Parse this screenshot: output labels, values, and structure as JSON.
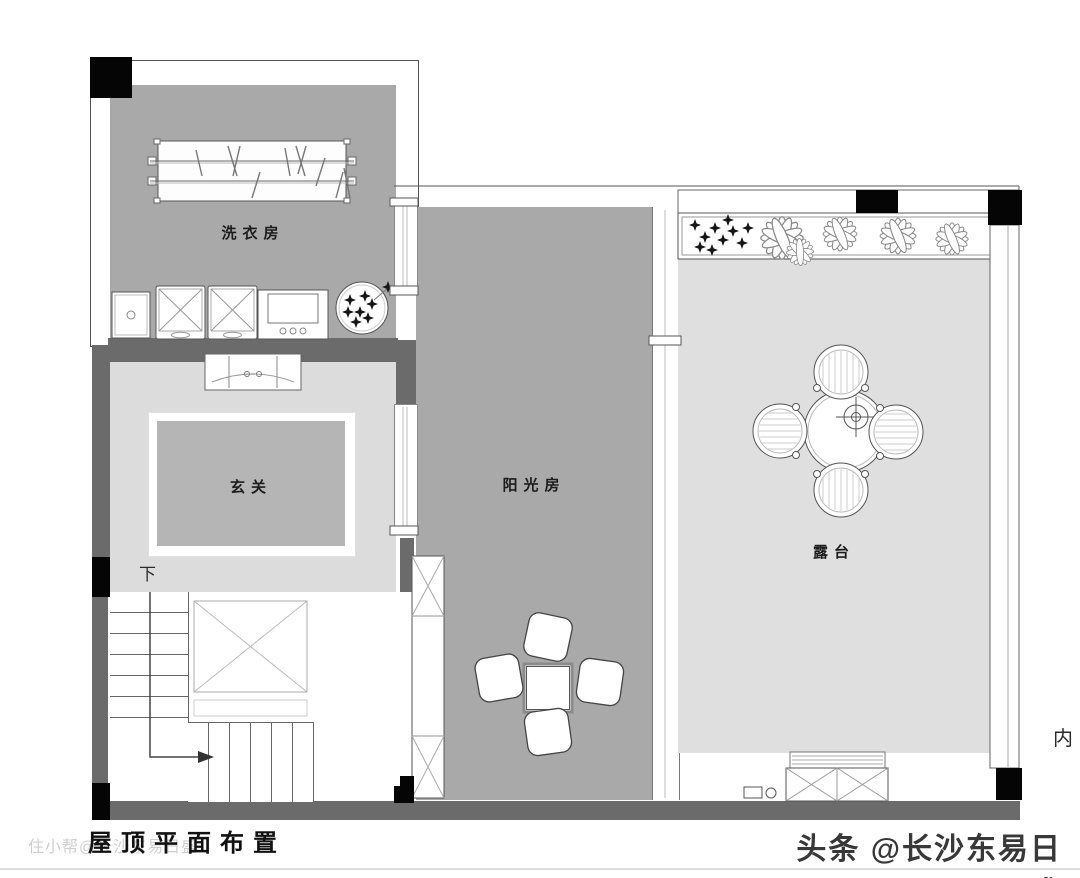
{
  "meta": {
    "drawing_title": "屋顶平面布置"
  },
  "rooms": {
    "laundry": {
      "label": "洗衣房"
    },
    "foyer": {
      "label": "玄关"
    },
    "sunroom": {
      "label": "阳光房"
    },
    "terrace": {
      "label": "露台"
    }
  },
  "annotations": {
    "stair_down": "下",
    "right_edge": "内"
  },
  "watermarks": {
    "title_underlay": "住小帮@长沙东易日盛",
    "bottom_right": "头条 @长沙东易日盛"
  },
  "colors": {
    "room_gray_dark": "#a9a9a9",
    "room_gray_light": "#dcdcdc",
    "terrace_gray": "#dfdfdf",
    "rug_gray": "#b5b5b5",
    "wall_gray": "#6b6b6b",
    "column_black": "#050505",
    "line": "#555555"
  }
}
